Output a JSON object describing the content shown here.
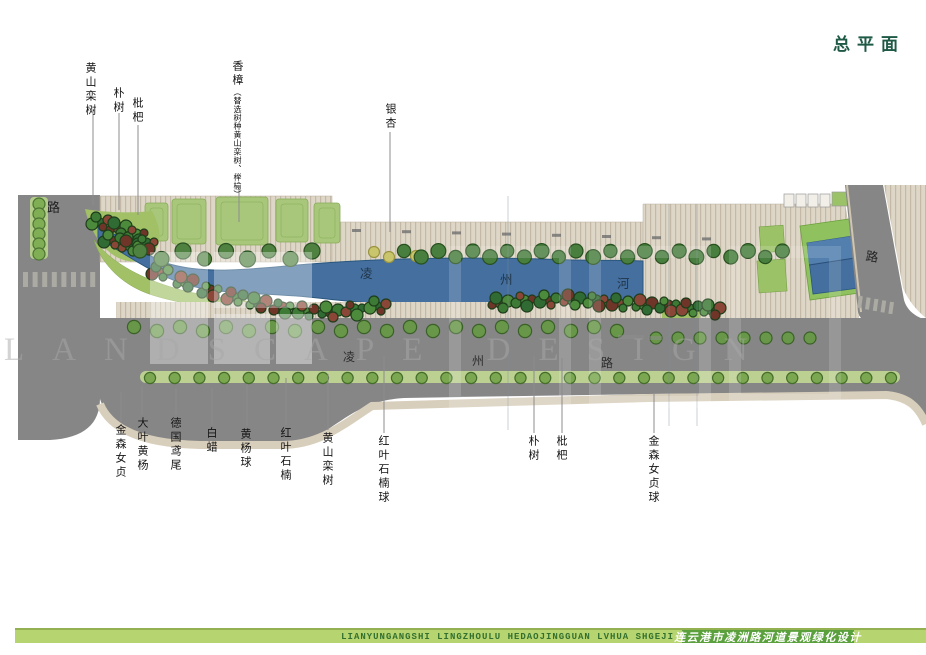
{
  "page_title": "总平面",
  "top_labels": [
    {
      "text": "黄山栾树"
    },
    {
      "text": "朴树"
    },
    {
      "text": "枇杷"
    },
    {
      "main": "香樟",
      "note": "（替选树种黄山栾树、榉榆）"
    },
    {
      "text": "银杏"
    }
  ],
  "bottom_labels": [
    {
      "text": "金森女贞"
    },
    {
      "text": "大叶黄杨"
    },
    {
      "text": "德国鸢尾"
    },
    {
      "text": "白蜡"
    },
    {
      "text": "黄杨球"
    },
    {
      "text": "红叶石楠"
    },
    {
      "text": "黄山栾树"
    },
    {
      "text": "红叶石楠球"
    },
    {
      "text": "朴树"
    },
    {
      "text": "枇杷"
    },
    {
      "text": "金森女贞球"
    }
  ],
  "plan": {
    "left_road_label": "路",
    "right_road_label": "路",
    "river_name_chars": [
      "凌",
      "州",
      "河"
    ],
    "road_name_chars": [
      "凌",
      "州",
      "路"
    ]
  },
  "watermark": {
    "text": "LANDSCAPE DESIGN"
  },
  "footer": {
    "latin": "LIANYUNGANGSHI LINGZHOULU HEDAOJINGGUAN LVHUA SHGEJI",
    "chinese": "连云港市凌洲路河道景观绿化设计"
  },
  "colors": {
    "title_green": "#1e5a45",
    "footer_bar": "#b6d46f",
    "footer_bar_edge": "#94b152",
    "footer_bar_text": "#33702f",
    "footer_block": "#5aa03c",
    "river_blue": "#446f9e",
    "bank_green": "#a2c167",
    "lawn_green": "#a9c77b",
    "road_gray": "#868686",
    "paving_beige": "#ded6c6",
    "tree_green": "#4f8140",
    "median_green": "#bcd092",
    "label_ink": "#141414"
  }
}
